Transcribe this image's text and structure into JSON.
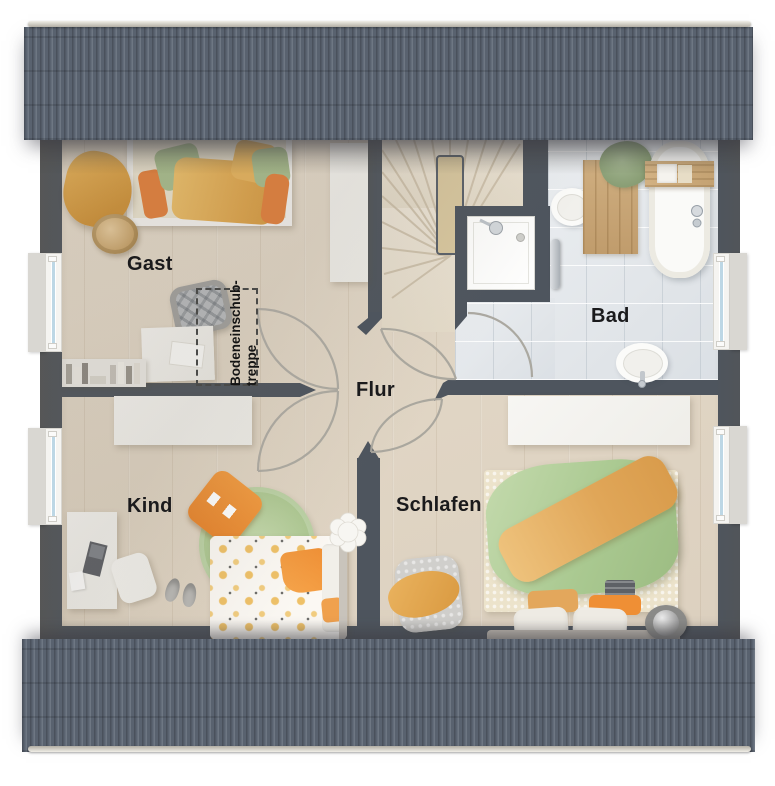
{
  "rooms": {
    "gast": {
      "label": "Gast"
    },
    "bad": {
      "label": "Bad"
    },
    "flur": {
      "label": "Flur"
    },
    "kind": {
      "label": "Kind"
    },
    "schlafen": {
      "label": "Schlafen"
    },
    "attic_hatch": {
      "line1": "Bodeneinschub-",
      "line2": "treppe"
    }
  },
  "colors": {
    "wall": "#4e555e",
    "roof": "#59626f",
    "roof_ridge": "#d9d5cc",
    "floor_wood": "#e3d9c9",
    "floor_tile": "#e7eaed",
    "accent_orange": "#ee9140",
    "accent_yellow": "#ecbc63",
    "accent_green": "#abc595",
    "accent_mustard": "#e0a94f",
    "furniture_white": "#f4f3f0",
    "label_text": "#1a1a1c",
    "door_arc": "#a8a59d"
  }
}
